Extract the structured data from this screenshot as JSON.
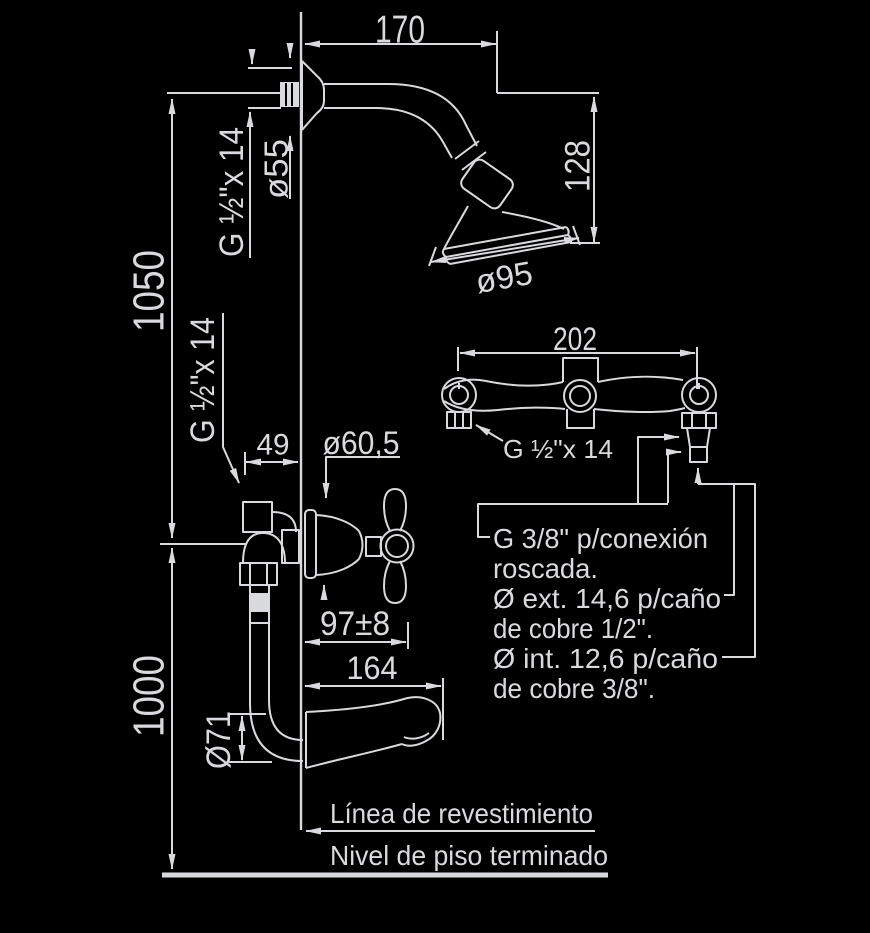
{
  "diagram": {
    "background_color": "#000000",
    "line_color": "#d9dadd",
    "labels": {
      "dim_170": "170",
      "dim_o55": "ø55",
      "thread_top": "G ½\"x 14",
      "dim_128": "128",
      "dim_o95": "ø95",
      "dim_1050": "1050",
      "thread_mid": "G ½\"x 14",
      "dim_49": "49",
      "dim_o605": "ø60,5",
      "dim_97": "97±8",
      "dim_164": "164",
      "dim_o71": "Ø71",
      "dim_1000": "1000",
      "dim_202": "202",
      "thread_right": "G ½\"x 14",
      "note_g38_1": "G 3/8\" p/conexión",
      "note_g38_2": "roscada.",
      "note_ext_1": "Ø ext. 14,6 p/caño",
      "note_ext_2": "de cobre 1/2\".",
      "note_int_1": "Ø int. 12,6 p/caño",
      "note_int_2": "de cobre 3/8\".",
      "wall_finish_line": "Línea de revestimiento",
      "floor_level_line": "Nivel de piso terminado"
    }
  }
}
